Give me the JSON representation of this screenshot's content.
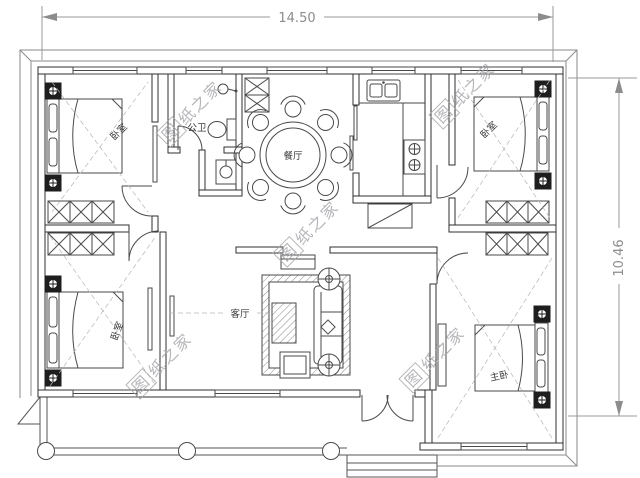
{
  "dimensions": {
    "width_label": "14.50",
    "height_label": "10.46"
  },
  "rooms": {
    "bedroom_top_left": "卧室",
    "bathroom": "公卫",
    "dining_room": "餐厅",
    "bedroom_top_right": "卧室",
    "bedroom_bottom_left": "卧室",
    "living_room": "客厅",
    "master_bedroom": "主卧"
  },
  "watermark": {
    "boxed_char": "图",
    "text_rest": "纸之家",
    "full_text": "图纸之家"
  },
  "colors": {
    "wall_line": "#2f2f2f",
    "dimension": "#8c8c8c",
    "watermark": "#a5a5aa",
    "background": "#ffffff"
  }
}
